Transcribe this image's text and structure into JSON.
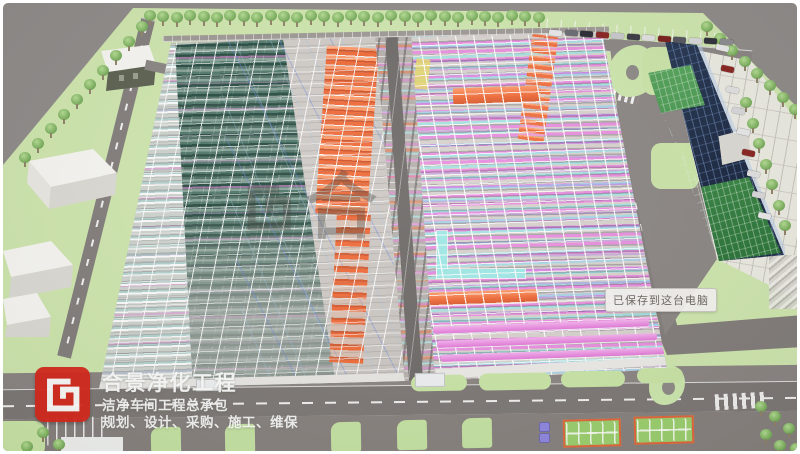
{
  "branding": {
    "logo_icon": "hejing-square-spiral-logo",
    "logo_color": "#d7271b",
    "company_name": "合景净化工程",
    "tagline": "洁净车间工程总承包",
    "services": "规划、设计、采购、施工、维保"
  },
  "toast": {
    "text": "已保存到这台电脑"
  },
  "watermark": {
    "glyph_icon": "hejing-square-spiral-logo",
    "character": "合"
  },
  "scene": {
    "palette": {
      "margin_gray": "#8f8b89",
      "grass": "#cfe6ae",
      "road": "#7d7875",
      "floor": "#d0cbc7",
      "pipe_magenta": "#ee7ee4",
      "pipe_cyan": "#9fe8e6",
      "duct_orange": "#f07040",
      "pipe_violet": "#af73eb",
      "equipment_teal": "#2f4a42",
      "glass_navy": "#1e2c45",
      "glass_green": "#3f8f4a"
    }
  }
}
